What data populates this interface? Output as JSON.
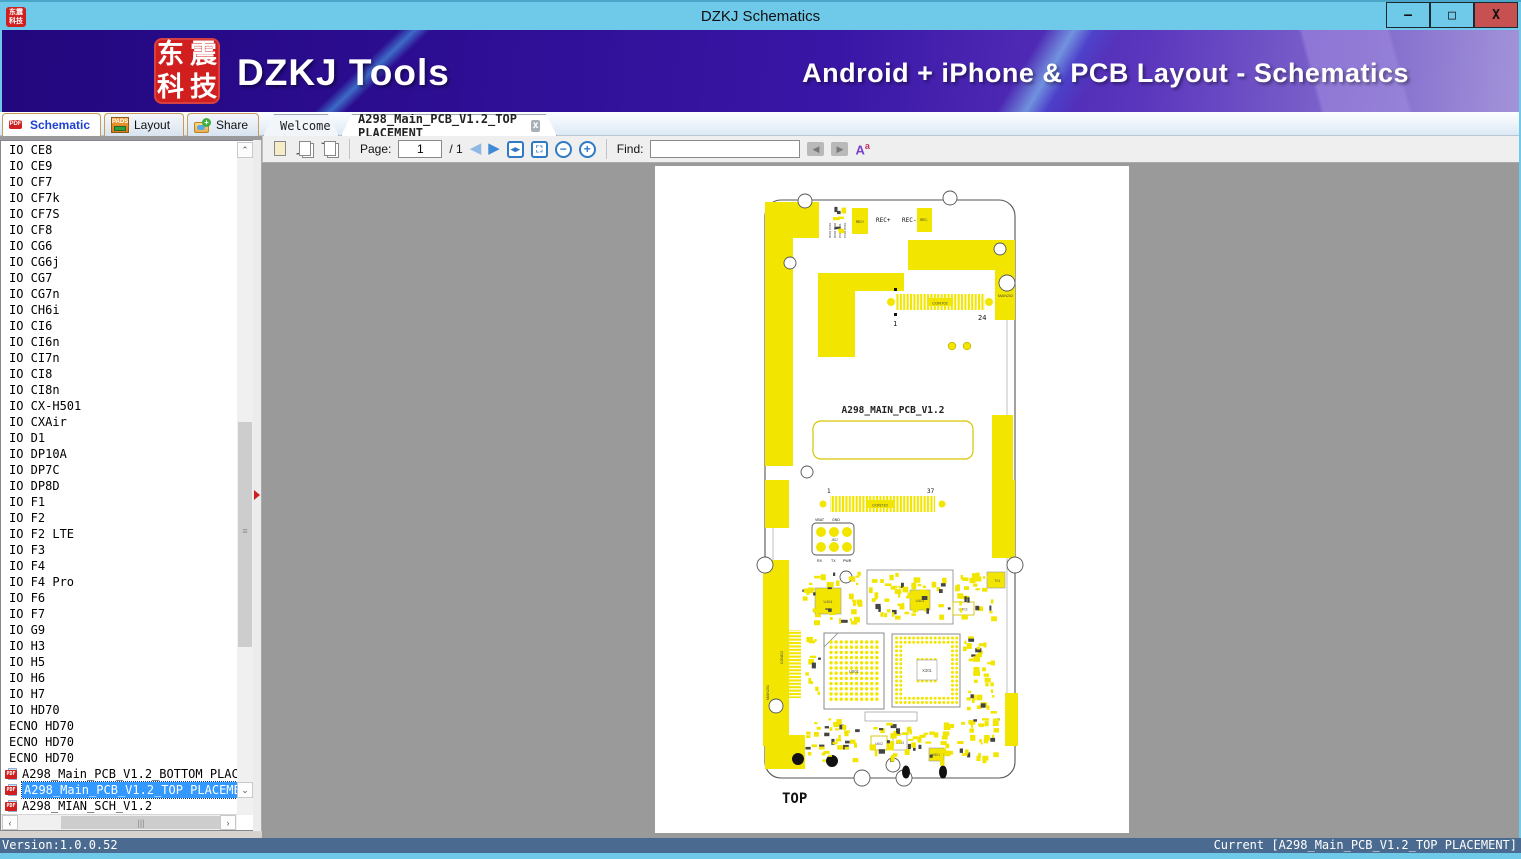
{
  "window": {
    "title": "DZKJ Schematics",
    "logo_chars": [
      "东",
      "震",
      "科",
      "技"
    ],
    "minimize": "–",
    "maximize": "□",
    "close": "X"
  },
  "banner": {
    "brand": "DZKJ Tools",
    "tagline": "Android + iPhone & PCB Layout - Schematics"
  },
  "tabs": {
    "schematic": "Schematic",
    "layout": "Layout",
    "share": "Share",
    "pdf_badge": "PDF",
    "pads_badge": "PADS",
    "doc_tabs": [
      {
        "label": "Welcome"
      },
      {
        "label": "A298_Main_PCB_V1.2_TOP PLACEMENT"
      }
    ],
    "close_glyph": "x"
  },
  "toolbar": {
    "page_label": "Page:",
    "page_value": "1",
    "page_total": "/ 1",
    "find_label": "Find:",
    "find_value": "",
    "font_icon": "A"
  },
  "sidebar": {
    "items": [
      {
        "label": "IO CE8"
      },
      {
        "label": "IO CE9"
      },
      {
        "label": "IO CF7"
      },
      {
        "label": "IO CF7k"
      },
      {
        "label": "IO CF7S"
      },
      {
        "label": "IO CF8"
      },
      {
        "label": "IO CG6"
      },
      {
        "label": "IO CG6j"
      },
      {
        "label": "IO CG7"
      },
      {
        "label": "IO CG7n"
      },
      {
        "label": "IO CH6i"
      },
      {
        "label": "IO CI6"
      },
      {
        "label": "IO CI6n"
      },
      {
        "label": "IO CI7n"
      },
      {
        "label": "IO CI8"
      },
      {
        "label": "IO CI8n"
      },
      {
        "label": "IO CX-H501"
      },
      {
        "label": "IO CXAir"
      },
      {
        "label": "IO D1"
      },
      {
        "label": "IO DP10A"
      },
      {
        "label": "IO DP7C"
      },
      {
        "label": "IO DP8D"
      },
      {
        "label": "IO F1"
      },
      {
        "label": "IO F2"
      },
      {
        "label": "IO F2 LTE"
      },
      {
        "label": "IO F3"
      },
      {
        "label": "IO F4"
      },
      {
        "label": "IO F4 Pro"
      },
      {
        "label": "IO F6"
      },
      {
        "label": "IO F7"
      },
      {
        "label": "IO G9"
      },
      {
        "label": "IO H3"
      },
      {
        "label": "IO H5"
      },
      {
        "label": "IO H6"
      },
      {
        "label": "IO H7"
      },
      {
        "label": "IO HD70"
      },
      {
        "label": "ECNO HD70"
      },
      {
        "label": "ECNO HD70"
      },
      {
        "label": "ECNO HD70"
      },
      {
        "label": "A298_Main_PCB_V1.2_BOTTOM PLACEMENT",
        "icon": "pdf"
      },
      {
        "label": "A298_Main_PCB_V1.2_TOP PLACEMENT",
        "icon": "pdf",
        "selected": true
      },
      {
        "label": "A298_MIAN_SCH_V1.2",
        "icon": "pdf"
      }
    ]
  },
  "statusbar": {
    "version": "Version:1.0.0.52",
    "current": "Current [A298_Main_PCB_V1.2_TOP PLACEMENT]"
  },
  "pcb": {
    "title": "A298_MAIN_PCB_V1.2",
    "view_label": "TOP",
    "rec_plus": "REC+",
    "rec_minus": "REC-",
    "con_top": "CON702",
    "con_top_pin_first": "1",
    "con_top_pin_last": "24",
    "con_bottom": "CON710",
    "con_bottom_pin_first": "1",
    "con_bottom_pin_last": "37",
    "con_left": "CON802",
    "jig_ref": "J802",
    "jig_vbat": "VBAT",
    "jig_gnd": "GND",
    "jig_rx": "RX",
    "jig_tx": "TX",
    "jig_pwr": "PWR",
    "u501": "U501",
    "x301": "X301",
    "u401": "U401",
    "u404": "U404",
    "u403": "U403",
    "u701": "U701",
    "u602": "U602",
    "u603": "U603",
    "x801": "X801",
    "main201": "MAIN201",
    "main202": "MAIN202"
  },
  "colors": {
    "accent_yellow": "#f2e600",
    "selection_blue": "#3399ff",
    "title_blue": "#6fc9e8",
    "close_red": "#c75050",
    "banner_purple": "#2d0e93"
  }
}
